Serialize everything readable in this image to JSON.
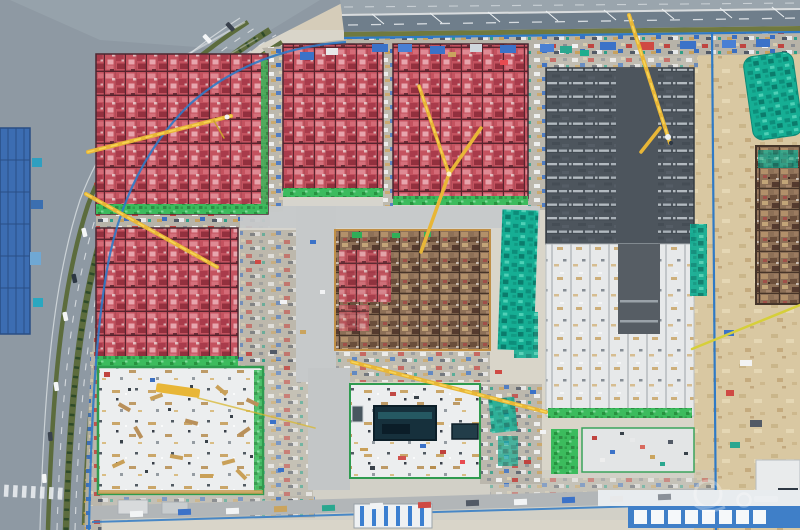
{
  "scene": {
    "title": "Aerial drone photo of a large construction site beside an urban road",
    "description": "Top-down aerial photograph. A fenced construction site fills most of the frame with eight building blocks in different phases: four red-pink formwork decks with dark grid lines, one tan timber-formwork deck, one dark concrete roof slab with white stripe rows, and white foundation slabs (one containing a dark rectangular pit). Yellow tower-crane jibs cross the blocks diagonally. Bright green safety netting edges the red blocks and teal tarpaulins cover stockpiles. A multi-lane city road with green medians, a crosswalk and cars runs down the left side past a blue-roofed building; an elevated highway with lamp posts runs along the top; blue hoarding encloses the site; temporary site offices with white-and-blue roofs line the bottom edge.",
    "no_visible_text": true,
    "watermark": {
      "present": true,
      "legible": false,
      "position": "bottom-right"
    }
  },
  "palette": {
    "red_formwork": "#c4525f",
    "formwork_grid_dark": "#58242e",
    "timber_formwork": "#8d7057",
    "dark_slab": "#4d555d",
    "slab_stripe": "#b3bac0",
    "white_slab": "#eceeef",
    "safety_net_green": "#3cbb5d",
    "tarp_teal": "#16ae94",
    "crane_yellow": "#e8b637",
    "hoarding_blue": "#2f7ac6",
    "road_gray": "#8e99a3",
    "highway_gray": "#6f7e8b",
    "median_green": "#5c6c3d",
    "sand_ground": "#d9c8a2",
    "pit_dark": "#16303c",
    "blue_roof": "#3c6db2"
  },
  "counts": {
    "building_blocks": 8,
    "red_formwork_blocks": 4,
    "crane_jibs_visible": 7
  },
  "regions": [
    {
      "id": "highway-top",
      "label": "Elevated highway along top edge with lane dashes and lamp posts"
    },
    {
      "id": "city-road-left",
      "label": "Curving multi-lane city road with green planted medians, crosswalk and cars"
    },
    {
      "id": "blue-roof-building",
      "label": "Blue-roofed building at far left edge"
    },
    {
      "id": "site-hoarding",
      "label": "Blue perimeter hoarding fence around the site"
    },
    {
      "id": "block-red-a",
      "label": "Red formwork block, upper left, green net border, crane jib across"
    },
    {
      "id": "block-red-b",
      "label": "Red formwork block, top middle-left"
    },
    {
      "id": "block-red-c",
      "label": "Red formwork block, top middle-right, crossed crane jibs"
    },
    {
      "id": "block-dark-slab",
      "label": "Dark concrete slab block with white stripe rows, top right, crane jib"
    },
    {
      "id": "block-red-e",
      "label": "Red formwork block, mid left"
    },
    {
      "id": "block-timber-f",
      "label": "Tan timber formwork block, centre, red patch at its left"
    },
    {
      "id": "block-white-g",
      "label": "White foundation slab, bottom left, scattered timber"
    },
    {
      "id": "block-white-h",
      "label": "White slab with vertical strip pattern below dark slab, right side"
    },
    {
      "id": "block-pit-i",
      "label": "White slab with dark rectangular excavation pit, bottom centre"
    },
    {
      "id": "pad-j",
      "label": "Concrete pad with material clutter, bottom right"
    },
    {
      "id": "teal-tarps",
      "label": "Teal tarpaulin covered stockpiles between and right of blocks"
    },
    {
      "id": "sand-strip-right",
      "label": "Sandy ground strip along right edge with tarped mound and timber block"
    },
    {
      "id": "site-offices-bottom",
      "label": "Temporary site offices with white and blue roofs along bottom"
    },
    {
      "id": "bottom-service-road",
      "label": "Service road with parked trucks and containers along bottom of site"
    },
    {
      "id": "tower-crane-jibs",
      "label": "Yellow tower crane jibs crossing the site"
    },
    {
      "id": "watermark",
      "label": "Faint illegible white watermark, bottom right"
    }
  ]
}
